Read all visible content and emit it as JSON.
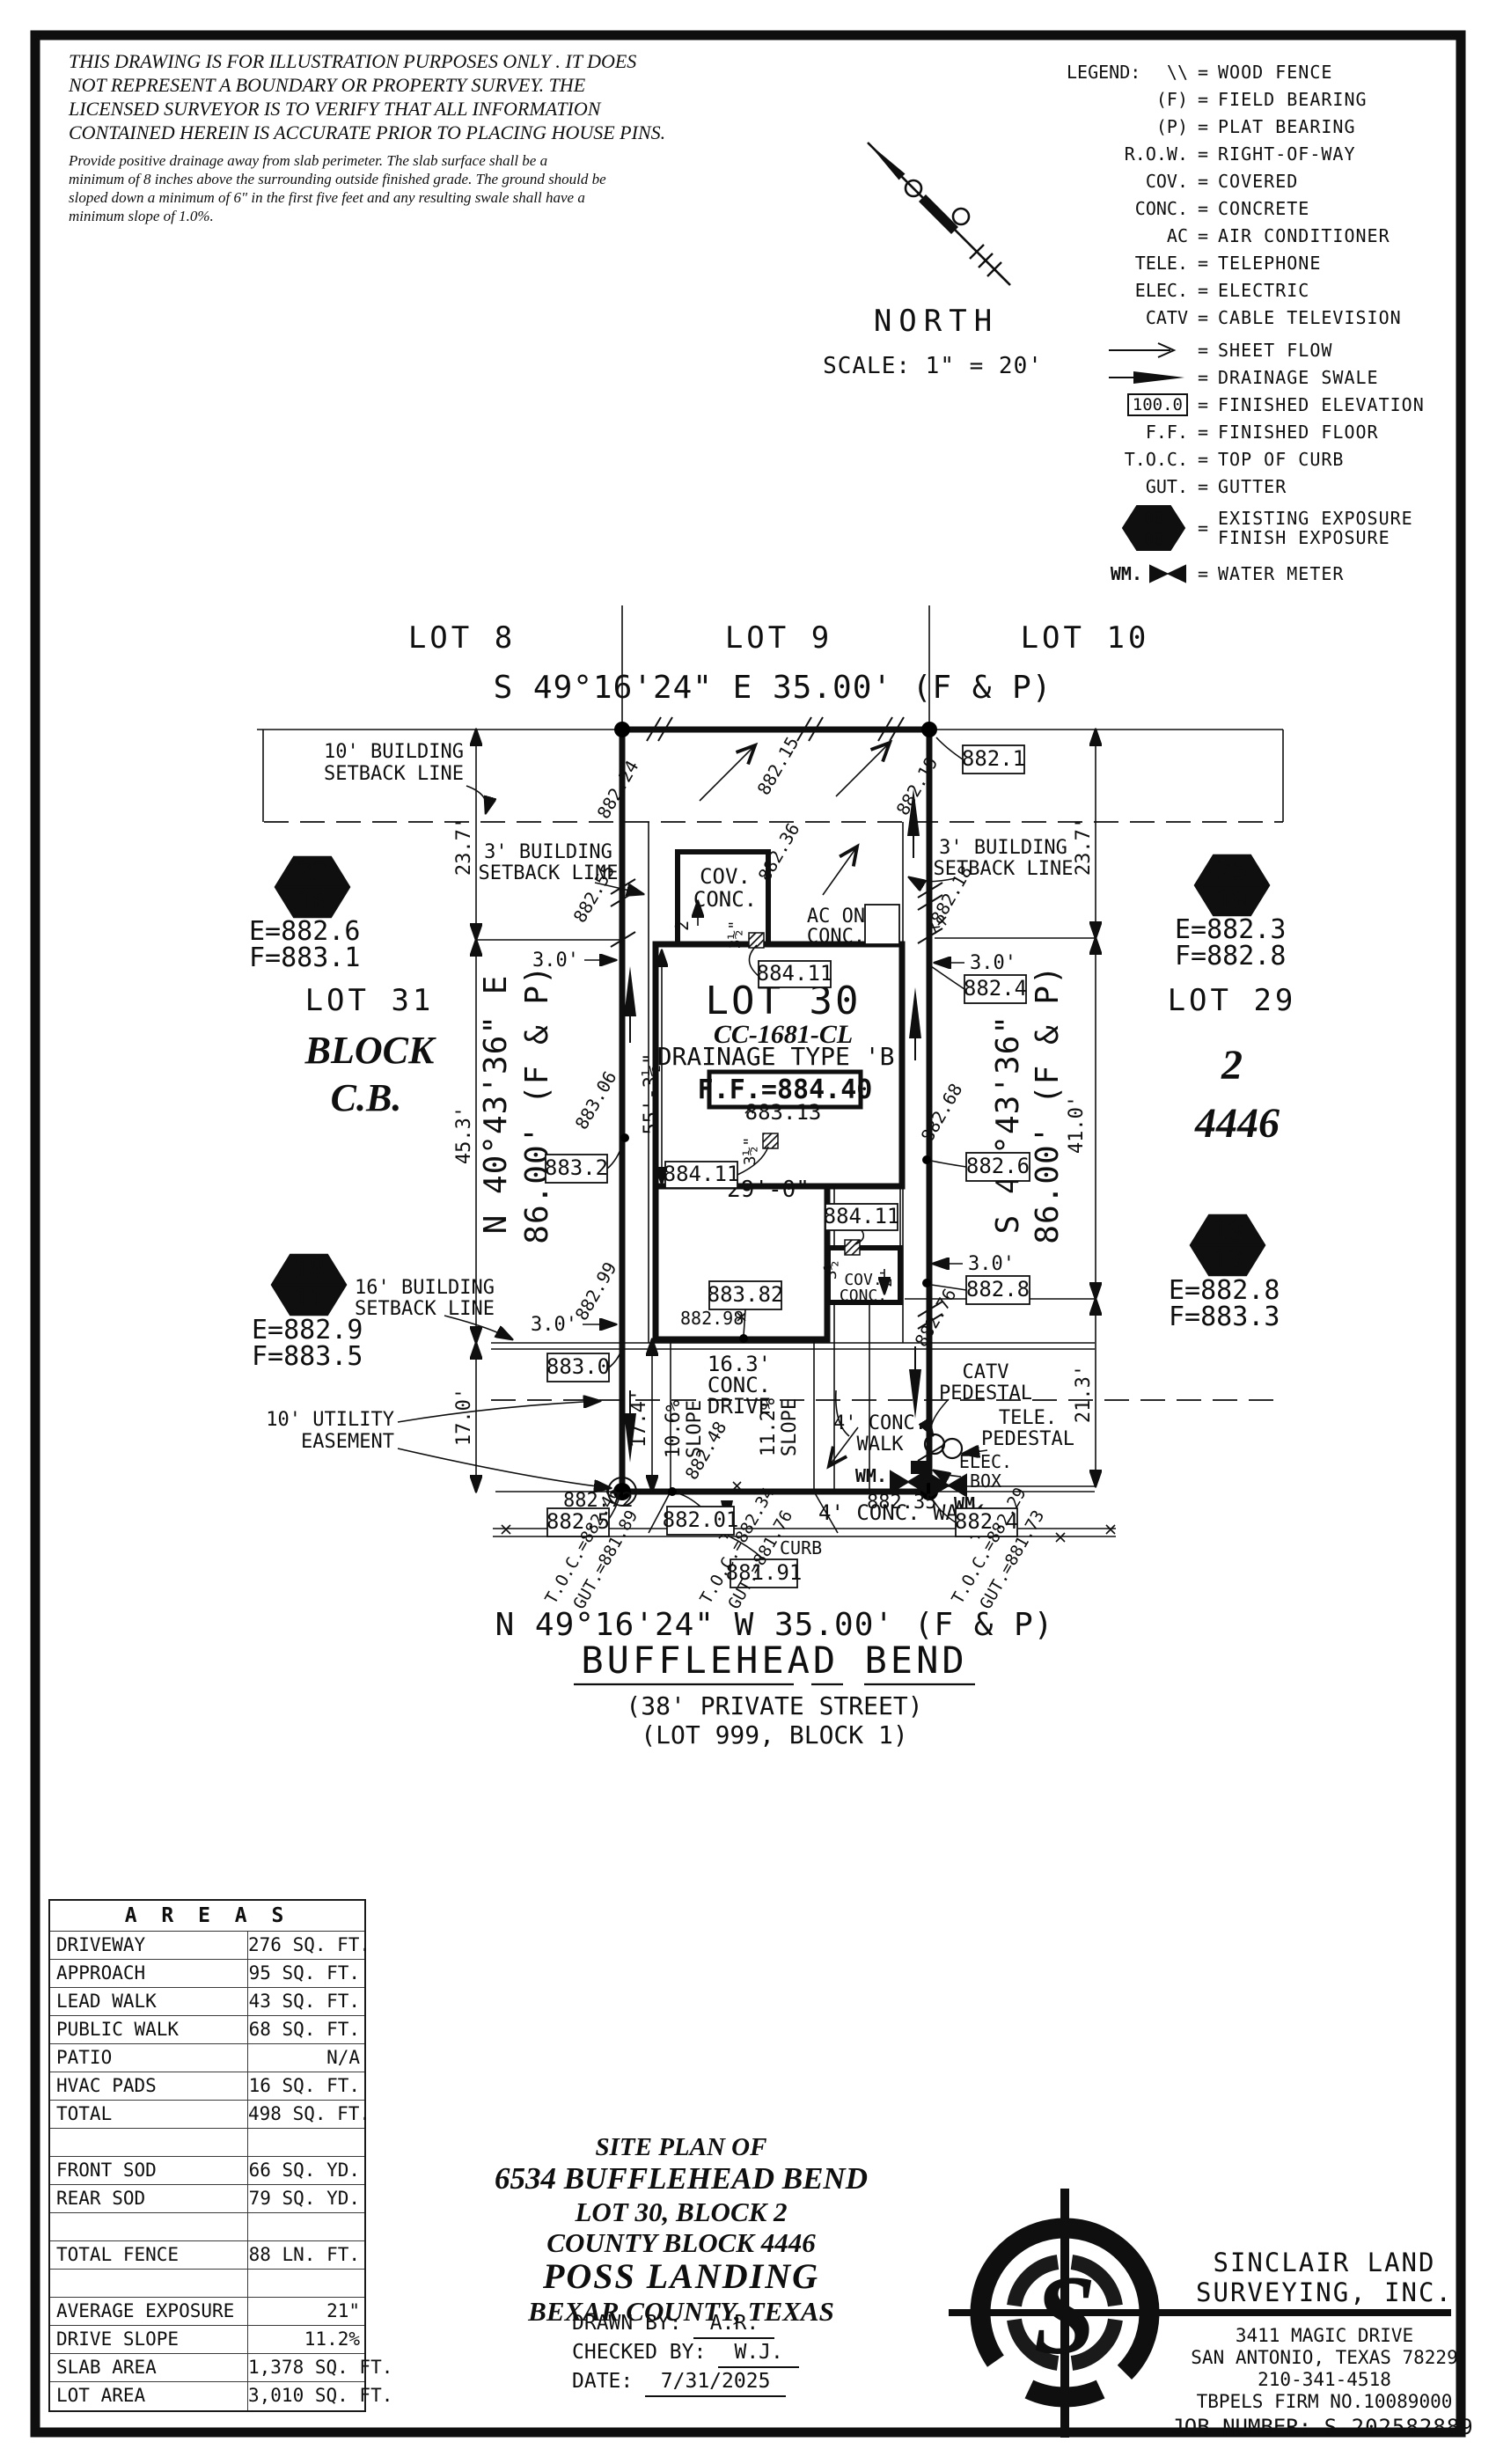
{
  "disclaimer": {
    "lines": [
      "THIS DRAWING IS FOR ILLUSTRATION PURPOSES ONLY . IT DOES",
      "NOT REPRESENT A BOUNDARY OR PROPERTY SURVEY. THE",
      "LICENSED SURVEYOR IS TO VERIFY THAT ALL INFORMATION",
      "CONTAINED HEREIN IS ACCURATE PRIOR TO PLACING HOUSE PINS."
    ],
    "note_lines": [
      "Provide positive drainage away from slab perimeter. The slab surface shall be a",
      "minimum of 8 inches above the surrounding outside finished grade. The ground should be",
      "sloped down a minimum of 6\" in the first five feet and any resulting swale shall have a",
      "minimum slope of 1.0%."
    ]
  },
  "north": {
    "label": "NORTH",
    "scale": "SCALE: 1\" = 20'"
  },
  "legend": {
    "title": "LEGEND:",
    "eq": "=",
    "rows": [
      {
        "symbol": "\\\\",
        "label": "WOOD FENCE"
      },
      {
        "symbol": "(F)",
        "label": "FIELD BEARING"
      },
      {
        "symbol": "(P)",
        "label": "PLAT BEARING"
      },
      {
        "symbol": "R.O.W.",
        "label": "RIGHT-OF-WAY"
      },
      {
        "symbol": "COV.",
        "label": "COVERED"
      },
      {
        "symbol": "CONC.",
        "label": "CONCRETE"
      },
      {
        "symbol": "AC",
        "label": "AIR CONDITIONER"
      },
      {
        "symbol": "TELE.",
        "label": "TELEPHONE"
      },
      {
        "symbol": "ELEC.",
        "label": "ELECTRIC"
      },
      {
        "symbol": "CATV",
        "label": "CABLE TELEVISION"
      },
      {
        "symbol": "",
        "label": "SHEET FLOW"
      },
      {
        "symbol": "",
        "label": "DRAINAGE SWALE"
      },
      {
        "symbol": "100.0",
        "label": "FINISHED ELEVATION"
      },
      {
        "symbol": "F.F.",
        "label": "FINISHED FLOOR"
      },
      {
        "symbol": "T.O.C.",
        "label": "TOP OF CURB"
      },
      {
        "symbol": "GUT.",
        "label": "GUTTER"
      },
      {
        "symbol": "00",
        "symbol2": "00",
        "label": "EXISTING EXPOSURE",
        "label2": "FINISH EXPOSURE"
      },
      {
        "symbol": "WM.",
        "label": "WATER METER"
      }
    ]
  },
  "plan": {
    "lots": {
      "lot8": "LOT 8",
      "lot9": "LOT 9",
      "lot10": "LOT 10",
      "lot31": "LOT 31",
      "lot29": "LOT 29",
      "lot30": "LOT 30",
      "block_word": "BLOCK",
      "block_cb": "C.B.",
      "right_block": "2",
      "right_cb": "4446"
    },
    "bearings": {
      "top": "S 49°16'24\" E 35.00' (F & P)",
      "bottom": "N 49°16'24\" W 35.00' (F & P)",
      "left_a": "N 40°43'36\" E",
      "left_b": "86.00' (F & P)",
      "right_a": "S 40°43'36\" W",
      "right_b": "86.00' (F & P)"
    },
    "street": {
      "name": "BUFFLEHEAD BEND",
      "type": "(38' PRIVATE STREET)",
      "lot": "(LOT 999, BLOCK 1)"
    },
    "house": {
      "model": "CC-1681-CL",
      "drainage": "DRAINAGE TYPE 'B'",
      "ff": "F.F.=884.40",
      "ff_grade": "883.13",
      "cov_a": "COV.",
      "cov_b": "CONC.",
      "ac_a": "AC ON",
      "ac_b": "CONC."
    },
    "setbacks": {
      "b10_a": "10' BUILDING",
      "b10_b": "SETBACK LINE",
      "b3_a": "3' BUILDING",
      "b3_b": "SETBACK LINE",
      "b16_a": "16' BUILDING",
      "b16_b": "SETBACK LINE",
      "ue_a": "10' UTILITY",
      "ue_b": "EASEMENT"
    },
    "dims": {
      "d237": "23.7'",
      "d453": "45.3'",
      "d170": "17.0'",
      "d410": "41.0'",
      "d213": "21.3'",
      "d174": "17.4'",
      "d553": "55'-3½\"",
      "d290": "29'-0\"",
      "d30": "3.0'",
      "d2": "2'",
      "d35": "3½\"",
      "d163_a": "16.3'",
      "d163_b": "CONC.",
      "d163_c": "DRIVE",
      "slope1_a": "10.6%",
      "slope1_b": "SLOPE",
      "slope2_a": "11.2%",
      "slope2_b": "SLOPE"
    },
    "exposure": {
      "h1_top": "22",
      "h1_bot": "16",
      "h1_e": "E=882.6",
      "h1_f": "F=883.1",
      "h2_top": "25",
      "h2_bot": "19",
      "h2_e": "E=882.3",
      "h2_f": "F=882.8",
      "h3_top": "18",
      "h3_bot": "11",
      "h3_e": "E=882.9",
      "h3_f": "F=883.5",
      "h4_top": "19",
      "h4_bot": "13",
      "h4_e": "E=882.8",
      "h4_f": "F=883.3"
    },
    "spots": {
      "s1": "882.24",
      "s2": "882.15",
      "s3": "882.19",
      "s4": "882.55",
      "s5": "882.36",
      "s6": "x882.18",
      "s7": "883.06",
      "s8": "882.68",
      "s9": "882.99",
      "s10": "882.76",
      "s11": "882.48",
      "s12": "882.98",
      "s13": "882.72",
      "s14": "882.35"
    },
    "boxes": {
      "b1": "882.1",
      "b2": "882.4",
      "b3": "882.6",
      "b4": "882.8",
      "b5": "883.2",
      "b6": "883.0",
      "b7": "883.82",
      "b8": "884.11",
      "b9": "882.5",
      "b10": "882.01",
      "b11": "881.91",
      "b12": "882.4"
    },
    "curb": {
      "label": "CURB",
      "toc1": "T.O.C.=882.46",
      "gut1": "GUT.=881.89",
      "toc2": "T.O.C.=882.34",
      "gut2": "GUT.=881.76",
      "toc3": "T.O.C.=882.29",
      "gut3": "GUT.=881.73"
    },
    "features": {
      "walk_a": "4' CONC.",
      "walk_b": "WALK",
      "walk2": "4' CONC. WALK",
      "catv_a": "CATV",
      "catv_b": "PEDESTAL",
      "tele_a": "TELE.",
      "tele_b": "PEDESTAL",
      "elec_a": "ELEC.",
      "elec_b": "BOX",
      "wm": "WM."
    }
  },
  "areas": {
    "title": "A R E A S",
    "rows": [
      {
        "label": "DRIVEWAY",
        "value": "276 SQ. FT."
      },
      {
        "label": "APPROACH",
        "value": "95 SQ. FT."
      },
      {
        "label": "LEAD WALK",
        "value": "43 SQ. FT."
      },
      {
        "label": "PUBLIC WALK",
        "value": "68 SQ. FT."
      },
      {
        "label": "PATIO",
        "value": "N/A"
      },
      {
        "label": "HVAC PADS",
        "value": "16 SQ. FT."
      },
      {
        "label": "TOTAL",
        "value": "498 SQ. FT."
      },
      {
        "label": "",
        "value": ""
      },
      {
        "label": "FRONT SOD",
        "value": "66 SQ. YD."
      },
      {
        "label": "REAR SOD",
        "value": "79 SQ. YD."
      },
      {
        "label": "",
        "value": ""
      },
      {
        "label": "TOTAL FENCE",
        "value": "88 LN. FT."
      },
      {
        "label": "",
        "value": ""
      },
      {
        "label": "AVERAGE EXPOSURE",
        "value": "21\""
      },
      {
        "label": "DRIVE SLOPE",
        "value": "11.2%"
      },
      {
        "label": "SLAB AREA",
        "value": "1,378 SQ. FT."
      },
      {
        "label": "LOT AREA",
        "value": "3,010 SQ. FT."
      }
    ]
  },
  "title_block": {
    "l1": "SITE PLAN OF",
    "l2": "6534 BUFFLEHEAD BEND",
    "l3": "LOT 30, BLOCK 2",
    "l4": "COUNTY BLOCK 4446",
    "l5": "POSS LANDING",
    "l6": "BEXAR COUNTY, TEXAS",
    "drawn_label": "DRAWN BY:",
    "drawn_value": "A.R.",
    "checked_label": "CHECKED BY:",
    "checked_value": "W.J.",
    "date_label": "DATE:",
    "date_value": "7/31/2025"
  },
  "firm": {
    "logo_letter": "S",
    "name1": "SINCLAIR LAND",
    "name2": "SURVEYING, INC.",
    "address1": "3411 MAGIC DRIVE",
    "address2": "SAN ANTONIO, TEXAS 78229",
    "phone": "210-341-4518",
    "firm_no": "TBPELS FIRM NO.10089000",
    "job_label": "JOB NUMBER:",
    "job_value": "S-202582889"
  },
  "colors": {
    "accent": "#C6572B",
    "ink": "#0f0f0f"
  }
}
